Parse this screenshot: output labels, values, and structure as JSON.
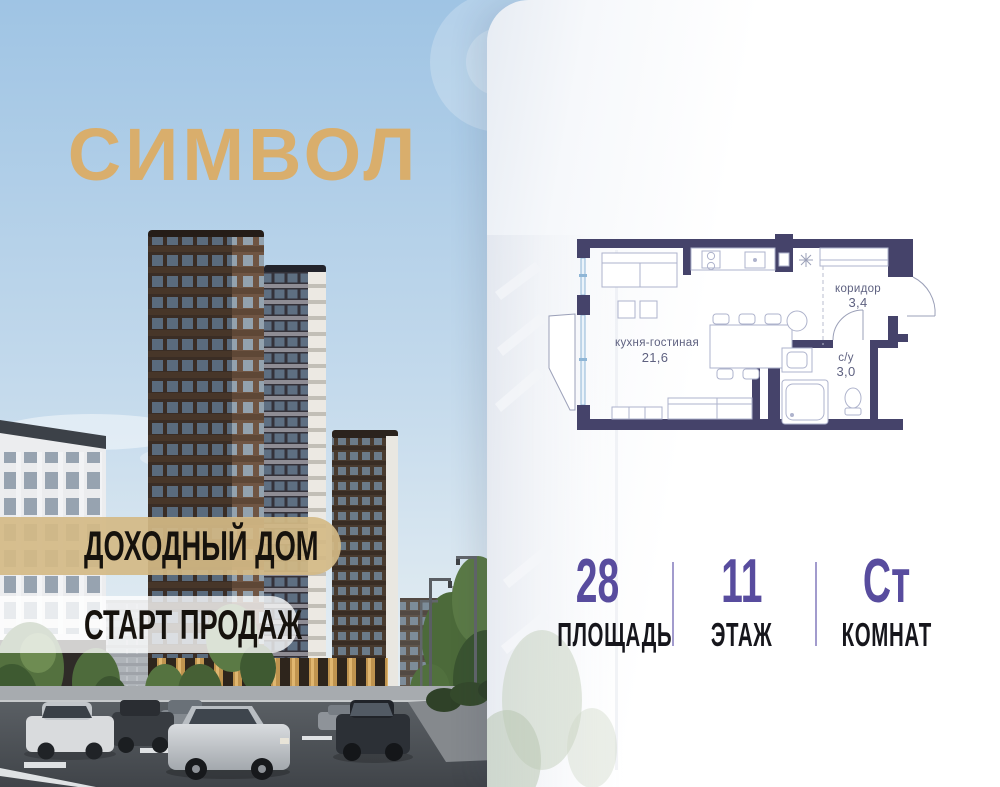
{
  "logo": {
    "text": "СИМВОЛ",
    "color": "#D9AE6C"
  },
  "banners": {
    "primary": {
      "text": "ДОХОДНЫЙ ДОМ",
      "bg": "#D4BA85"
    },
    "secondary": {
      "text": "СТАРТ ПРОДАЖ",
      "bg": "#FFFFFF"
    }
  },
  "floorplan": {
    "wall_color": "#45436A",
    "rooms": [
      {
        "name": "кухня-гостиная",
        "area": "21,6"
      },
      {
        "name": "коридор",
        "area": "3,4"
      },
      {
        "name": "с/у",
        "area": "3,0"
      }
    ]
  },
  "stats": {
    "value_color": "#584C9E",
    "items": [
      {
        "value": "28",
        "label": "ПЛОЩАДЬ"
      },
      {
        "value": "11",
        "label": "ЭТАЖ"
      },
      {
        "value": "Ст",
        "label": "КОМНАТ"
      }
    ]
  }
}
